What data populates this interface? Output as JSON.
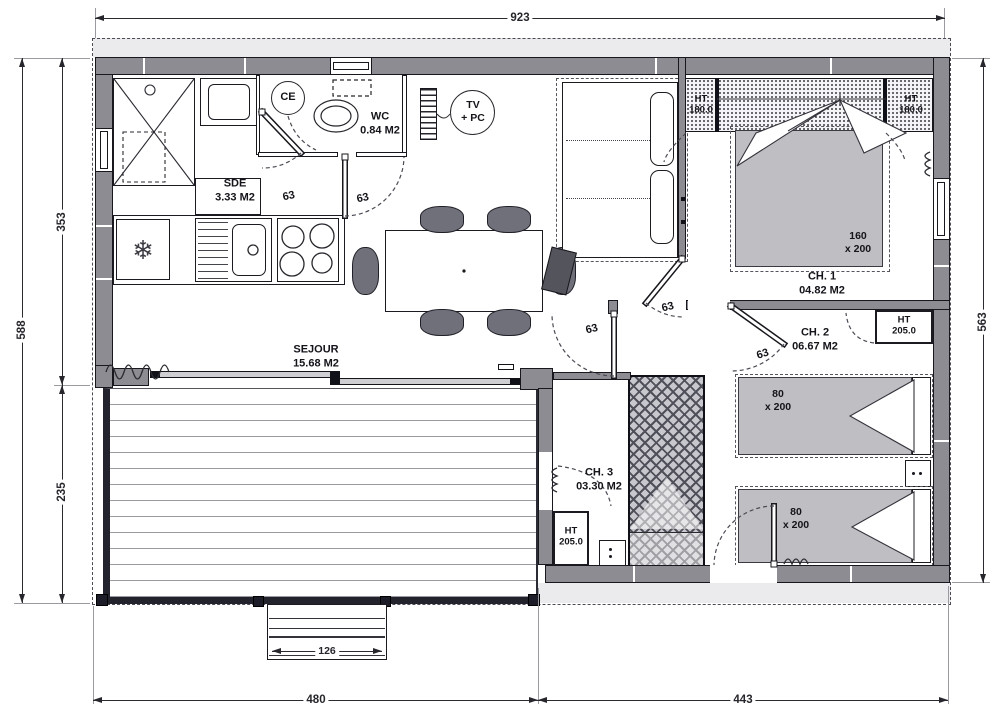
{
  "dimensions": {
    "overall_width": "923",
    "left_total": "588",
    "left_upper": "353",
    "left_lower": "235",
    "right_height": "563",
    "terrace_width": "480",
    "bedroom_width": "443",
    "steps_width": "126"
  },
  "rooms": {
    "sde": {
      "name": "SDE",
      "area": "3.33 M2"
    },
    "wc": {
      "name": "WC",
      "area": "0.84 M2"
    },
    "sejour": {
      "name": "SEJOUR",
      "area": "15.68 M2"
    },
    "ch1": {
      "name": "CH. 1",
      "area": "04.82 M2"
    },
    "ch2": {
      "name": "CH. 2",
      "area": "06.67 M2"
    },
    "ch3": {
      "name": "CH. 3",
      "area": "03.30 M2"
    }
  },
  "equipment": {
    "water_heater": "CE",
    "tv_line1": "TV",
    "tv_line2": "+ PC",
    "wardrobe_ht": "HT",
    "wardrobe_h180": "180.0",
    "wardrobe_h205": "205.0",
    "fridge_icon": "❄"
  },
  "beds": {
    "double_w": "160",
    "double_l": "x 200",
    "single_w": "80",
    "single_l": "x 200"
  },
  "doors": {
    "width": "63"
  },
  "colors": {
    "wall": "#8c8c92",
    "furniture_gray": "#bfbfc3",
    "chair": "#70707a",
    "deck_frame": "#23232e",
    "line": "#17171d"
  }
}
